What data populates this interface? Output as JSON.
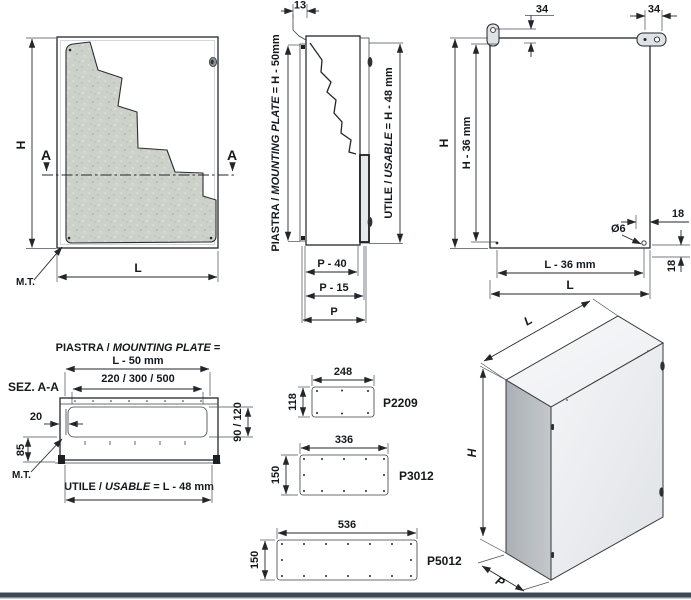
{
  "front_view": {
    "h_dim": "H",
    "l_dim": "L",
    "mt_label": "M.T.",
    "section_marker_left": "A",
    "section_marker_right": "A"
  },
  "side_view": {
    "top_dim": "13",
    "plate_dim": {
      "prefix": "PIASTRA / ",
      "italic": "MOUNTING PLATE",
      "suffix": " = H - 50mm"
    },
    "usable_dim": {
      "prefix": "UTILE / ",
      "italic": "USABLE",
      "suffix": " = H - 48 mm"
    },
    "depth_minus_40": "P - 40",
    "depth_minus_15": "P - 15",
    "depth": "P"
  },
  "rear_view": {
    "bracket_offset_left": "34",
    "bracket_offset_right": "34",
    "height_dim": "H",
    "height_minus_36": "H - 36 mm",
    "hole_offset_top": "18",
    "hole_offset_side": "18",
    "hole_diameter": "Ø6",
    "width_minus_36": "L - 36 mm",
    "width_dim": "L"
  },
  "section_view": {
    "title": "SEZ. A-A",
    "plate_dim_line1": {
      "prefix": "PIASTRA / ",
      "italic": "MOUNTING PLATE",
      "suffix": " ="
    },
    "plate_dim_line2": "L - 50 mm",
    "cutout_widths": "220 / 300 / 500",
    "wall_gap": "20",
    "rear_depth": "85",
    "cutout_heights": "90 / 120",
    "mt_label": "M.T.",
    "usable_dim": {
      "prefix": "UTILE / ",
      "italic": "USABLE",
      "suffix": " = L - 48 mm"
    }
  },
  "gland_plates": [
    {
      "model": "P2209",
      "width": "248",
      "height": "118"
    },
    {
      "model": "P3012",
      "width": "336",
      "height": "150"
    },
    {
      "model": "P5012",
      "width": "536",
      "height": "150"
    }
  ],
  "iso_view": {
    "width_dim": "L",
    "height_dim": "H",
    "depth_dim": "P"
  },
  "colors": {
    "line": "#23262a",
    "panel_fill": "#f0f2f4",
    "plate_texture": "#ccd1ca",
    "iso_side": "#b2b6ba",
    "bottom_bar": "#3f4857"
  }
}
